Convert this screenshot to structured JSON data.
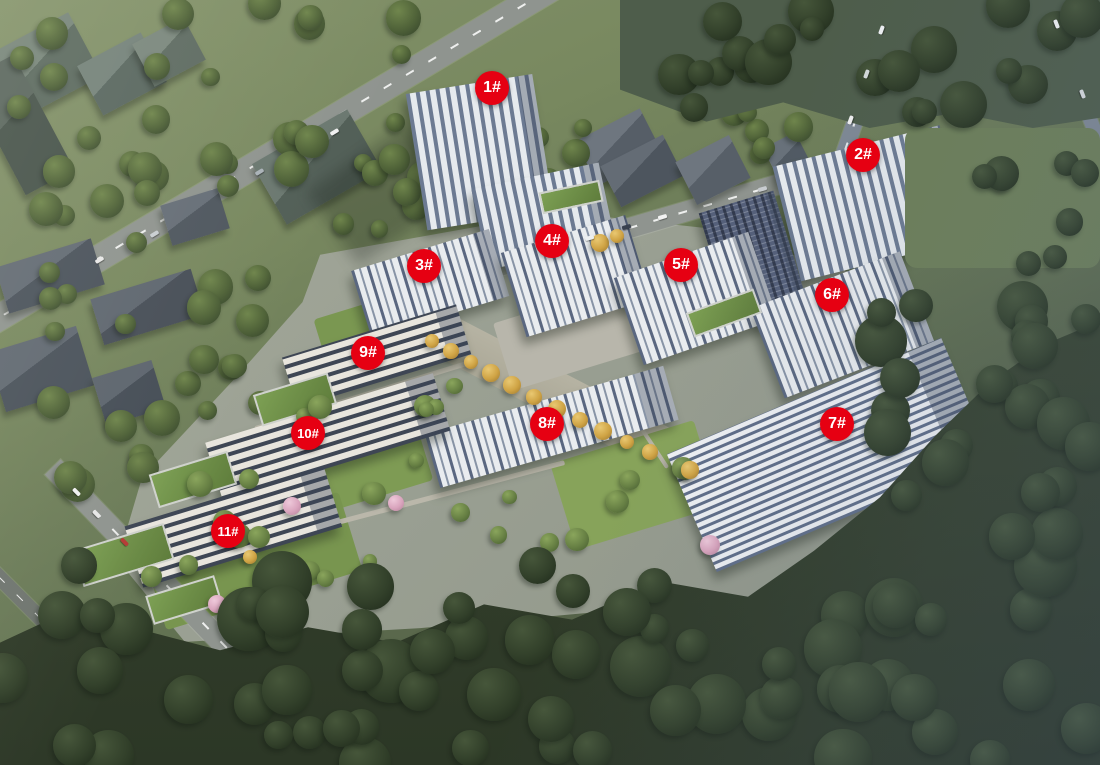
{
  "scene_description": "aerial rendering of residential complex with numbered buildings",
  "colors": {
    "marker_bg": "#e60012",
    "marker_text": "#ffffff"
  },
  "markers": [
    {
      "id": "1",
      "label": "1#",
      "x": 492,
      "y": 88
    },
    {
      "id": "2",
      "label": "2#",
      "x": 863,
      "y": 155
    },
    {
      "id": "3",
      "label": "3#",
      "x": 424,
      "y": 266
    },
    {
      "id": "4",
      "label": "4#",
      "x": 552,
      "y": 241
    },
    {
      "id": "5",
      "label": "5#",
      "x": 681,
      "y": 265
    },
    {
      "id": "6",
      "label": "6#",
      "x": 832,
      "y": 295
    },
    {
      "id": "7",
      "label": "7#",
      "x": 837,
      "y": 424
    },
    {
      "id": "8",
      "label": "8#",
      "x": 547,
      "y": 424
    },
    {
      "id": "9",
      "label": "9#",
      "x": 368,
      "y": 353
    },
    {
      "id": "10",
      "label": "10#",
      "x": 308,
      "y": 433
    },
    {
      "id": "11",
      "label": "11#",
      "x": 228,
      "y": 531
    }
  ]
}
